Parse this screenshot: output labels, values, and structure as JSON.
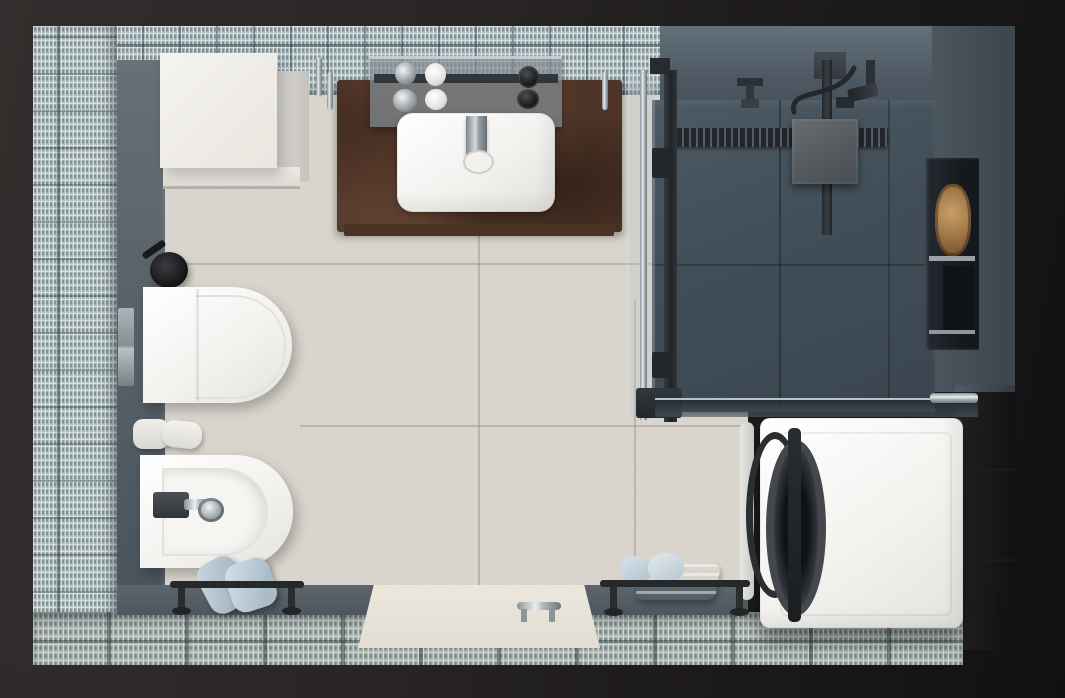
{
  "scene": {
    "title": "Bathroom and laundry room, top-down 3D render",
    "view": "plan view photorealistic render",
    "palette": {
      "background_dark": "#201d1d",
      "mosaic_tile": "#b2bec0",
      "floor_tile_cream": "#d9d5cd",
      "shower_slate": "#414e58",
      "wall_blue_gray": "#4a545d",
      "gray_wall_tile": "#6e767e",
      "counter_rust": "#6b4836",
      "fixture_white": "#f3f2ef",
      "towel_blue": "#bccad6",
      "matte_black": "#202427",
      "chrome": "#c9d0d4"
    },
    "zones": [
      {
        "id": "bath-zone",
        "label": "Bathroom zone with cream tile floor"
      },
      {
        "id": "shower-zone",
        "label": "Walk-in shower zone with slate floor"
      },
      {
        "id": "laundry-zone",
        "label": "Laundry corner with mosaic floor"
      }
    ],
    "fixtures": [
      {
        "id": "storage-cabinet",
        "label": "White storage cabinet"
      },
      {
        "id": "vanity",
        "label": "Rust metal vanity counter with white basin and chrome faucet"
      },
      {
        "id": "vanity-shelf",
        "label": "Mirrored shelf with soap dispensers, cups and bottles"
      },
      {
        "id": "toilet",
        "label": "Wall-hung toilet"
      },
      {
        "id": "flush-plate",
        "label": "Chrome wall flush plate"
      },
      {
        "id": "toilet-brush",
        "label": "Black toilet brush set"
      },
      {
        "id": "paper-rolls",
        "label": "Toilet paper rolls on wall holder"
      },
      {
        "id": "bidet",
        "label": "Wall-hung bidet with chrome mixer"
      },
      {
        "id": "towel-rail-left",
        "label": "Black floor towel rail with blue towels"
      },
      {
        "id": "entry-door",
        "label": "Entry door with chrome handle"
      },
      {
        "id": "towel-rail-right",
        "label": "Black floor towel rail with folded blue towels"
      },
      {
        "id": "rain-shower",
        "label": "Ceiling rain shower head"
      },
      {
        "id": "hand-shower",
        "label": "Hand shower with hose"
      },
      {
        "id": "shower-drain",
        "label": "Linear shower drain"
      },
      {
        "id": "glass-partition",
        "label": "Framed glass shower partition"
      },
      {
        "id": "glass-shelf",
        "label": "Glass shelf above washing machine"
      },
      {
        "id": "wall-niche",
        "label": "Recessed wall niche with baskets"
      },
      {
        "id": "washing-machine",
        "label": "Front-load washing machine"
      }
    ]
  }
}
